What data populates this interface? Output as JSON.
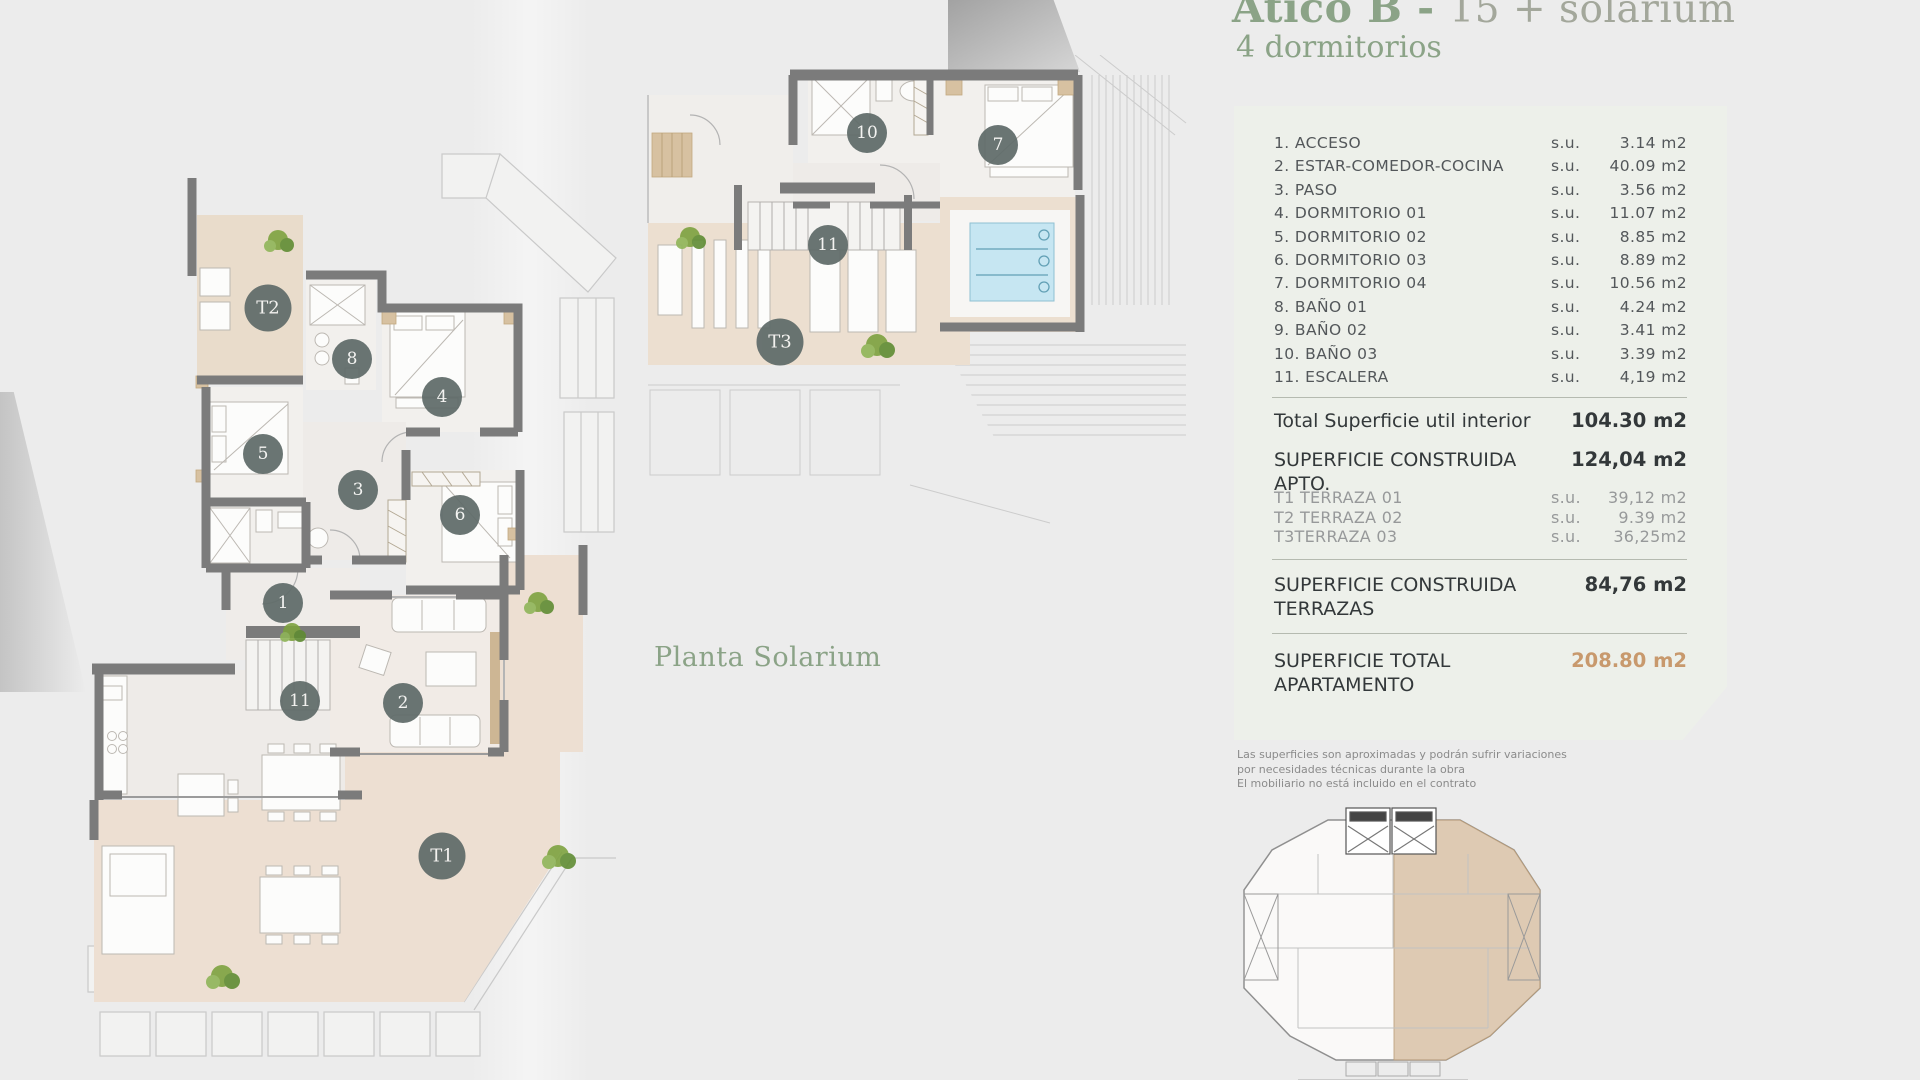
{
  "header": {
    "title_name": "Ático B - ",
    "title_unit": "15 + solarium",
    "subtitle": "4 dormitorios"
  },
  "plans": {
    "main": {
      "markers": [
        {
          "label": "T2",
          "x": 208,
          "y": 168,
          "big": true
        },
        {
          "label": "8",
          "x": 292,
          "y": 219
        },
        {
          "label": "4",
          "x": 382,
          "y": 257
        },
        {
          "label": "5",
          "x": 203,
          "y": 314
        },
        {
          "label": "3",
          "x": 298,
          "y": 350
        },
        {
          "label": "6",
          "x": 400,
          "y": 375
        },
        {
          "label": "1",
          "x": 223,
          "y": 463
        },
        {
          "label": "11",
          "x": 240,
          "y": 561
        },
        {
          "label": "2",
          "x": 343,
          "y": 563
        },
        {
          "label": "T1",
          "x": 382,
          "y": 716,
          "big": true
        }
      ]
    },
    "solarium": {
      "label": "Planta Solarium",
      "markers": [
        {
          "label": "10",
          "x": 237,
          "y": 78
        },
        {
          "label": "7",
          "x": 368,
          "y": 90
        },
        {
          "label": "11",
          "x": 198,
          "y": 190
        },
        {
          "label": "T3",
          "x": 150,
          "y": 287,
          "big": true
        }
      ]
    }
  },
  "panel": {
    "su": "s.u.",
    "rooms": [
      {
        "name": "1. ACCESO",
        "value": "3.14 m2"
      },
      {
        "name": "2. ESTAR-COMEDOR-COCINA",
        "value": "40.09 m2"
      },
      {
        "name": "3. PASO",
        "value": "3.56 m2"
      },
      {
        "name": "4. DORMITORIO 01",
        "value": "11.07 m2"
      },
      {
        "name": "5. DORMITORIO 02",
        "value": "8.85 m2"
      },
      {
        "name": "6. DORMITORIO 03",
        "value": "8.89 m2"
      },
      {
        "name": "7. DORMITORIO 04",
        "value": "10.56 m2"
      },
      {
        "name": "8. BAÑO 01",
        "value": "4.24 m2"
      },
      {
        "name": "9. BAÑO 02",
        "value": "3.41 m2"
      },
      {
        "name": "10. BAÑO 03",
        "value": "3.39 m2"
      },
      {
        "name": "11. ESCALERA",
        "value": "4,19 m2"
      }
    ],
    "total_interior": {
      "label": "Total Superficie util interior",
      "value": "104.30 m2"
    },
    "constructed_apt": {
      "label": "SUPERFICIE CONSTRUIDA APTO.",
      "value": "124,04 m2"
    },
    "terraces": [
      {
        "name": "T1 TERRAZA 01",
        "value": "39,12 m2"
      },
      {
        "name": "T2 TERRAZA 02",
        "value": "9.39 m2"
      },
      {
        "name": "T3TERRAZA 03",
        "value": "36,25m2"
      }
    ],
    "constructed_terraces": {
      "label": "SUPERFICIE CONSTRUIDA TERRAZAS",
      "value": "84,76 m2"
    },
    "total_apartment": {
      "label": "SUPERFICIE TOTAL APARTAMENTO",
      "value": "208.80 m2"
    },
    "disclaimer": [
      "Las superficies son aproximadas y podrán sufrir variaciones",
      "por necesidades técnicas durante la obra",
      "El mobiliario no está incluido en el contrato"
    ]
  },
  "colors": {
    "accent": "#c8996d",
    "title_green": "#8ba387",
    "unit_gray": "#a3a79b",
    "marker": "#5f6b69",
    "panel_bg": "#edf0ea",
    "wall": "#7b7b7b",
    "terrace": "#ecdfd0",
    "pool": "#c6e6f2"
  }
}
